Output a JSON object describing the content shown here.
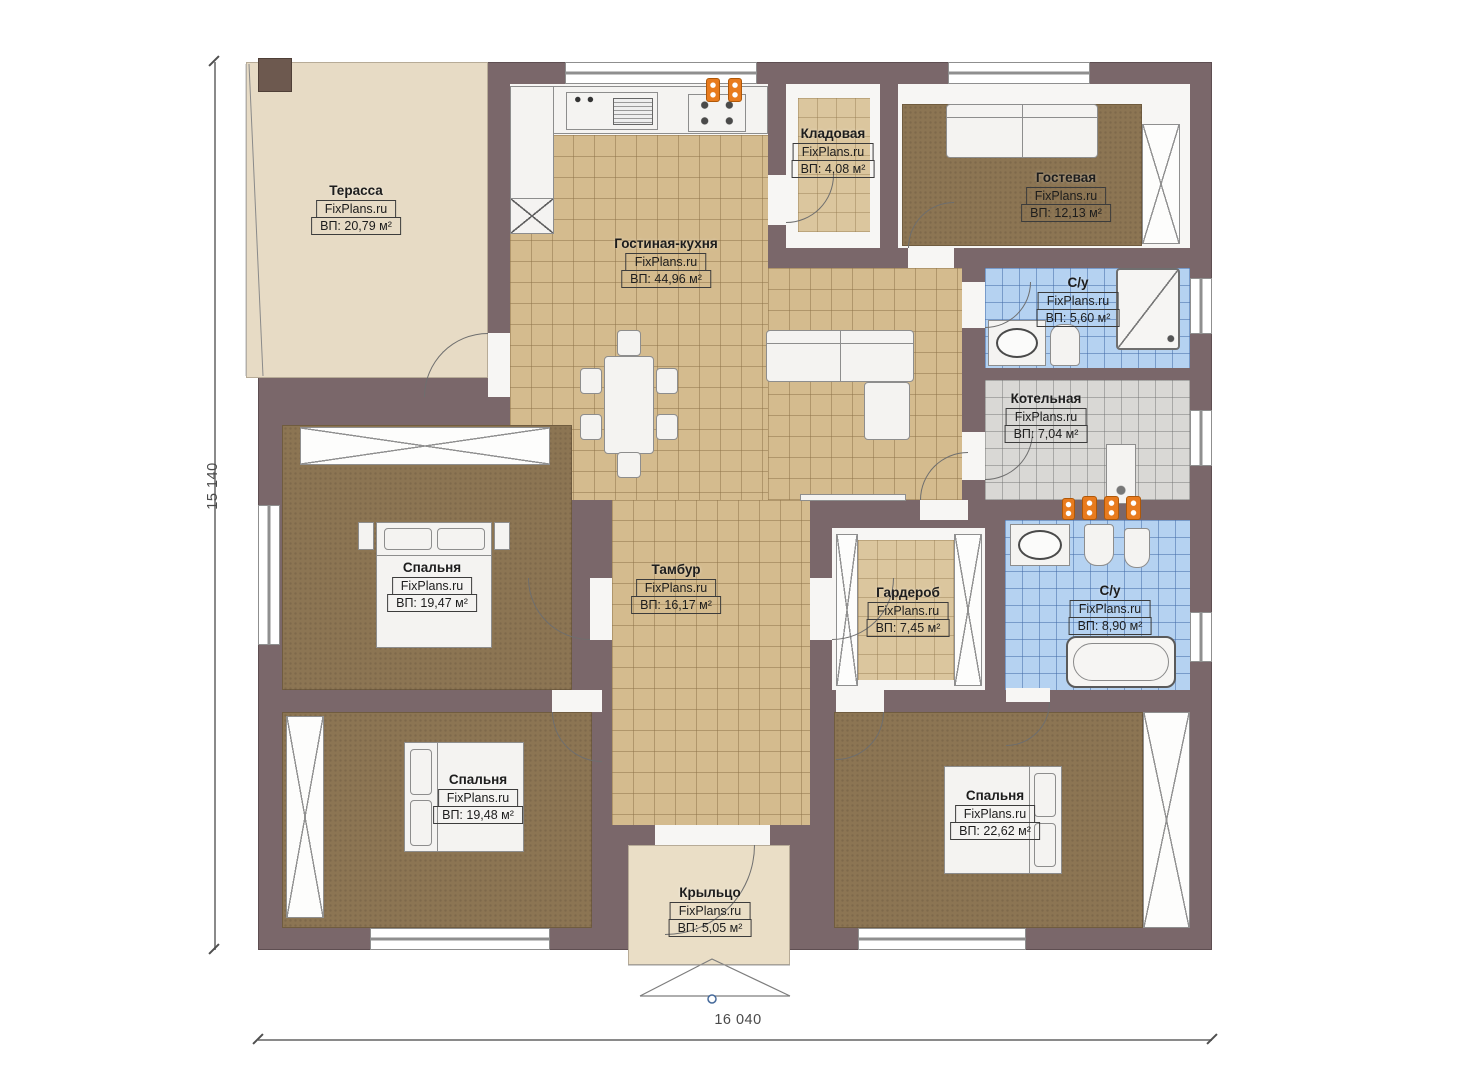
{
  "brand": "FixPlans.ru",
  "dimensions": {
    "height_label": "15 140",
    "width_label": "16 040"
  },
  "colors": {
    "wall": "#7a676a",
    "terrace_floor": "#e7dbc5",
    "porch_floor": "#eadec6",
    "tile_tan": "#d4bb8e",
    "tile_blue": "#b5d2f1",
    "tile_gray": "#d9d8d5",
    "carpet_brown": "#8c7553",
    "fixture_white": "#f4f3f1",
    "accent_orange": "#e87b1e"
  },
  "rooms": [
    {
      "id": "terrace",
      "name": "Терасса",
      "brand": "FixPlans.ru",
      "area": "ВП: 20,79 м²"
    },
    {
      "id": "living",
      "name": "Гостиная-кухня",
      "brand": "FixPlans.ru",
      "area": "ВП: 44,96 м²"
    },
    {
      "id": "storage",
      "name": "Кладовая",
      "brand": "FixPlans.ru",
      "area": "ВП: 4,08 м²"
    },
    {
      "id": "guest",
      "name": "Гостевая",
      "brand": "FixPlans.ru",
      "area": "ВП: 12,13 м²"
    },
    {
      "id": "bath1",
      "name": "С/у",
      "brand": "FixPlans.ru",
      "area": "ВП: 5,60 м²"
    },
    {
      "id": "boiler",
      "name": "Котельная",
      "brand": "FixPlans.ru",
      "area": "ВП: 7,04 м²"
    },
    {
      "id": "bedroom1",
      "name": "Спальня",
      "brand": "FixPlans.ru",
      "area": "ВП: 19,47 м²"
    },
    {
      "id": "hall",
      "name": "Тамбур",
      "brand": "FixPlans.ru",
      "area": "ВП: 16,17 м²"
    },
    {
      "id": "wardrobe",
      "name": "Гардероб",
      "brand": "FixPlans.ru",
      "area": "ВП: 7,45 м²"
    },
    {
      "id": "bath2",
      "name": "С/у",
      "brand": "FixPlans.ru",
      "area": "ВП: 8,90 м²"
    },
    {
      "id": "bedroom2",
      "name": "Спальня",
      "brand": "FixPlans.ru",
      "area": "ВП: 19,48 м²"
    },
    {
      "id": "bedroom3",
      "name": "Спальня",
      "brand": "FixPlans.ru",
      "area": "ВП: 22,62 м²"
    },
    {
      "id": "porch",
      "name": "Крыльцо",
      "brand": "FixPlans.ru",
      "area": "ВП: 5,05 м²"
    }
  ]
}
